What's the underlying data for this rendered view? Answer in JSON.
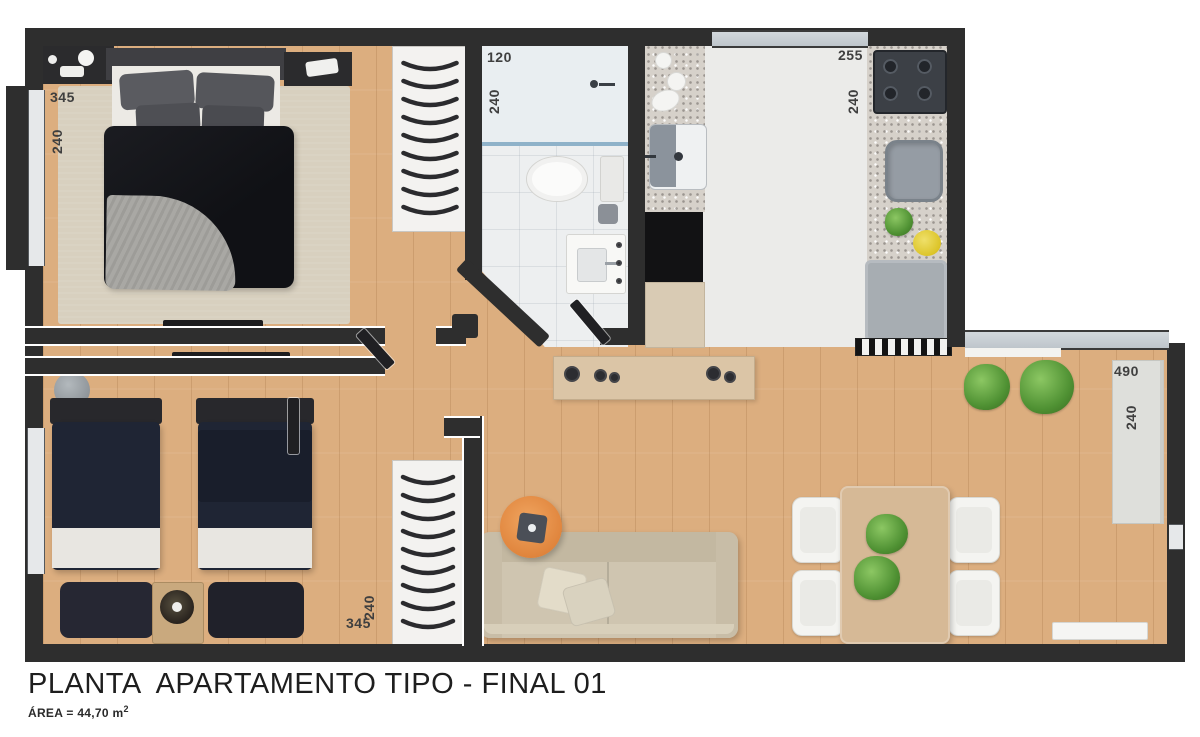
{
  "meta": {
    "title": "PLANTA  APARTAMENTO TIPO - FINAL 01",
    "area_label": "ÁREA = 44,70 m",
    "area_sup": "2"
  },
  "rooms": {
    "bedroom1": {
      "width_cm": "345",
      "depth_cm": "240"
    },
    "bedroom2": {
      "width_cm": "345",
      "depth_cm": "240"
    },
    "bathroom": {
      "width_cm": "120",
      "depth_cm": "240"
    },
    "kitchen": {
      "width_cm": "255",
      "depth_cm": "240"
    },
    "living_terrace": {
      "width_cm": "490",
      "depth_cm": "240"
    }
  },
  "colors": {
    "wall": "#2e2e2e",
    "wood": "#dcae7f",
    "rug": "#d8d0bf",
    "bath_floor": "#edeff0",
    "kitchen_floor": "#ebebe9",
    "granite": "#d6d1ca",
    "glass": "#c7ced4",
    "bed_dark": "#17181c",
    "bed_navy": "#1f2534",
    "sheet": "#e8e6e1",
    "sofa": "#cfc5b0",
    "table_wood": "#d6b996",
    "console_wood": "#dbc5a6",
    "accent_orange": "#e0853d",
    "plant_green": "#57a03c",
    "bowl_yellow": "#dcc428",
    "chair_white": "#f4f4f1",
    "wardrobe_white": "#f3f2f0",
    "label_text": "#3f3f3f",
    "title_text": "#1e1e1e"
  }
}
